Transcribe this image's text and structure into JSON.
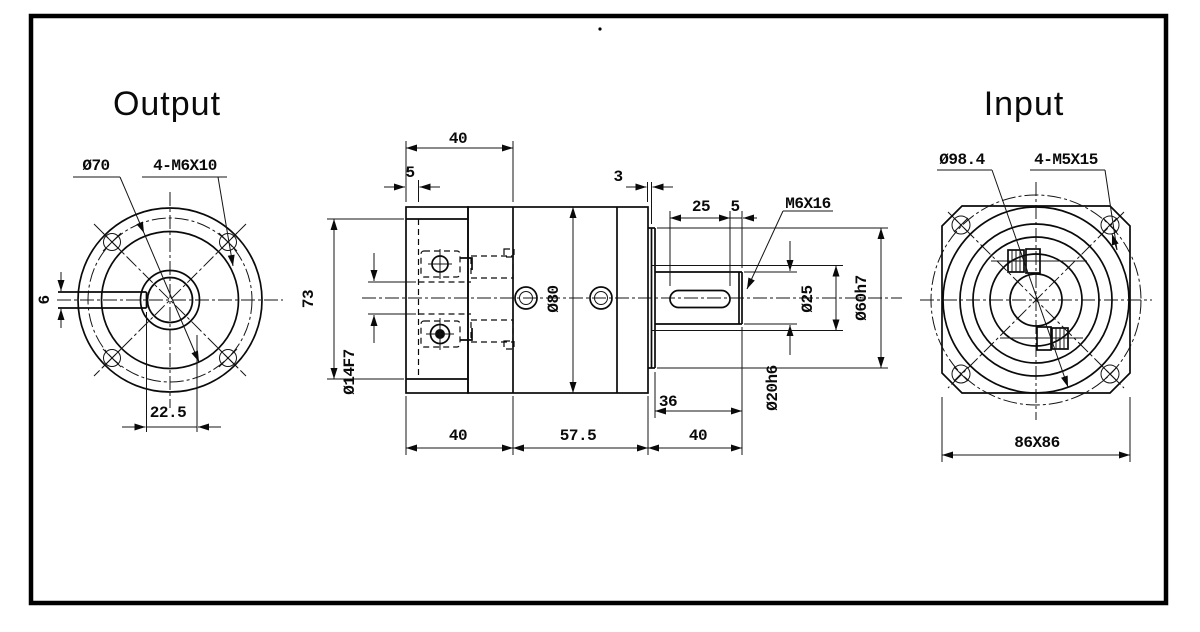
{
  "drawing": {
    "border_color": "#000000",
    "views": {
      "output": {
        "title": "Output",
        "labels": {
          "bolt_circle": "Ø70",
          "mount_holes": "4-M6X10",
          "key_width": "6",
          "key_offset": "22.5"
        }
      },
      "side": {
        "labels": {
          "input_section_length": "40",
          "pilot_depth": "5",
          "spacer_thickness": "3",
          "keyway_length": "25",
          "keyway_end_gap": "5",
          "shaft_end_tap": "M6X16",
          "flange_height": "73",
          "input_bore": "Ø14F7",
          "body_diameter": "Ø80",
          "shoulder_diameter": "Ø25",
          "pilot_diameter": "Ø60h7",
          "shaft_diameter": "Ø20h6",
          "front_length": "40",
          "mid_length": "57.5",
          "hub_length": "36",
          "shaft_length": "40"
        }
      },
      "input": {
        "title": "Input",
        "labels": {
          "bolt_circle": "Ø98.4",
          "mount_holes": "4-M5X15",
          "flange_size": "86X86"
        }
      }
    }
  }
}
